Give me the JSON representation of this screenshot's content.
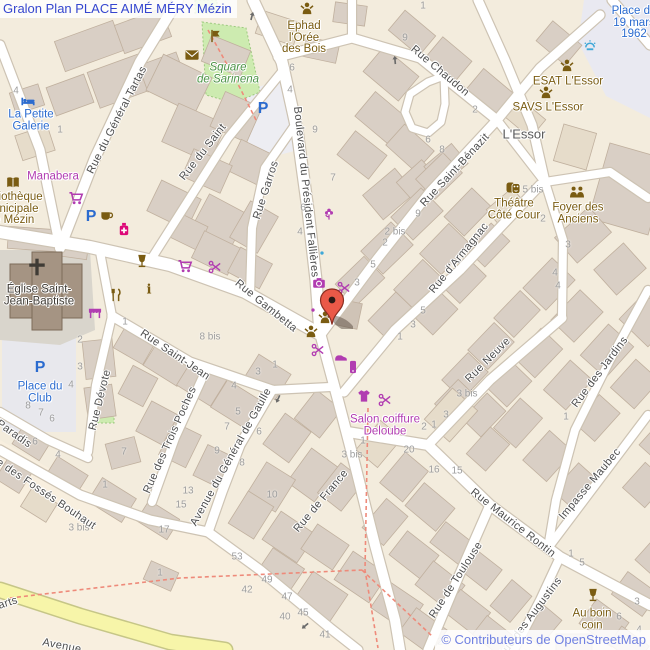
{
  "title": "Gralon Plan PLACE AIMÉ MÉRY Mézin",
  "attribution": "© Contributeurs de OpenStreetMap",
  "marker": {
    "x": 336,
    "y": 329,
    "color": "#ea5948"
  },
  "colors": {
    "purple": "#b13cb1",
    "brown": "#7a5c12",
    "pink": "#dd0878",
    "blue": "#2b6bcf",
    "green": "#4c9346",
    "gray_place": "#595959",
    "dark": "#3f3b35",
    "street": "#4d4d4d",
    "number": "#9e9e9e",
    "title": "#3546cf",
    "attribution": "#7081e2",
    "arrow": "#6b6b6b",
    "water": "#3fa8d8"
  },
  "streets": [
    {
      "t": "Rue du Général Tartas",
      "x": 117,
      "y": 120,
      "r": -63
    },
    {
      "t": "Rue du Saint",
      "x": 203,
      "y": 152,
      "r": -52
    },
    {
      "t": "Rue Garros",
      "x": 266,
      "y": 190,
      "r": -72
    },
    {
      "t": "Boulevard du Président Fallières",
      "x": 306,
      "y": 192,
      "r": 84
    },
    {
      "t": "Rue Chaudon",
      "x": 440,
      "y": 71,
      "r": 40
    },
    {
      "t": "Rue Saint-Bénazit",
      "x": 455,
      "y": 170,
      "r": -47
    },
    {
      "t": "Rue d'Armagnac",
      "x": 459,
      "y": 258,
      "r": -51
    },
    {
      "t": "Rue Gambetta",
      "x": 266,
      "y": 306,
      "r": 39
    },
    {
      "t": "Rue Saint-Jean",
      "x": 175,
      "y": 355,
      "r": 34
    },
    {
      "t": "Rue Dévote",
      "x": 100,
      "y": 400,
      "r": -76
    },
    {
      "t": "Rue des Trois Poches",
      "x": 170,
      "y": 440,
      "r": -66
    },
    {
      "t": "Avenue du Général de Gaulle",
      "x": 231,
      "y": 457,
      "r": -61
    },
    {
      "t": "Rue de France",
      "x": 321,
      "y": 501,
      "r": -50
    },
    {
      "t": "Rue Neuve",
      "x": 488,
      "y": 360,
      "r": -45
    },
    {
      "t": "Rue des Jardins",
      "x": 600,
      "y": 372,
      "r": -53
    },
    {
      "t": "Rue Maurice Rontin",
      "x": 513,
      "y": 523,
      "r": 38
    },
    {
      "t": "Impasse Maubec",
      "x": 590,
      "y": 484,
      "r": -50
    },
    {
      "t": "Rue de Toulouse",
      "x": 456,
      "y": 580,
      "r": -57
    },
    {
      "t": "Rue des Augustins",
      "x": 530,
      "y": 618,
      "r": -53
    },
    {
      "t": "Rue des Fossés Bouhaut",
      "x": 40,
      "y": 490,
      "r": 34
    },
    {
      "t": "Paradis",
      "x": 14,
      "y": 434,
      "r": 35
    },
    {
      "t": "arts",
      "x": 8,
      "y": 603,
      "r": -18
    },
    {
      "t": "Avenue",
      "x": 62,
      "y": 646,
      "r": 11
    }
  ],
  "pois": [
    {
      "n": "ephad-l-oree-des-bois",
      "lines": [
        "Ephad",
        "l'Orée",
        "des Bois"
      ],
      "x": 304,
      "y": 38,
      "c": "brown"
    },
    {
      "n": "square-de-sarinena",
      "lines": [
        "Square",
        "de Sarinena"
      ],
      "x": 228,
      "y": 74,
      "c": "green",
      "italic": true
    },
    {
      "n": "la-petite-galerie",
      "lines": [
        "La Petite",
        "Galerie"
      ],
      "x": 31,
      "y": 121,
      "c": "blue"
    },
    {
      "n": "manabera",
      "lines": [
        "Manabera"
      ],
      "x": 53,
      "y": 177,
      "c": "purple"
    },
    {
      "n": "bibliotheque-municipale",
      "lines": [
        "Bibliothèque",
        "municipale",
        "de Mézin"
      ],
      "x": 11,
      "y": 209,
      "c": "brown"
    },
    {
      "n": "eglise-saint-jean-baptiste",
      "lines": [
        "Église Saint-",
        "Jean-Baptiste"
      ],
      "x": 39,
      "y": 296,
      "c": "dark"
    },
    {
      "n": "place-du-club",
      "lines": [
        "Place du",
        "Club"
      ],
      "x": 40,
      "y": 393,
      "c": "blue"
    },
    {
      "n": "place-du-19-mars-1962",
      "lines": [
        "Place du",
        "19 mars",
        "1962"
      ],
      "x": 634,
      "y": 23,
      "c": "blue"
    },
    {
      "n": "esat-l-essor",
      "lines": [
        "ESAT L'Essor"
      ],
      "x": 568,
      "y": 82,
      "c": "brown"
    },
    {
      "n": "savs-l-essor",
      "lines": [
        "SAVS L'Essor"
      ],
      "x": 548,
      "y": 108,
      "c": "brown"
    },
    {
      "n": "l-essor",
      "lines": [
        "L'Essor"
      ],
      "x": 524,
      "y": 134,
      "c": "gray_place",
      "size": 13
    },
    {
      "n": "theatre-cote-cour",
      "lines": [
        "Théâtre",
        "Côté Cour"
      ],
      "x": 514,
      "y": 210,
      "c": "brown"
    },
    {
      "n": "foyer-des-anciens",
      "lines": [
        "Foyer des",
        "Anciens"
      ],
      "x": 578,
      "y": 214,
      "c": "brown"
    },
    {
      "n": "salon-coiffure-deloube",
      "lines": [
        "Salon coiffure",
        "Deloube"
      ],
      "x": 385,
      "y": 426,
      "c": "purple"
    },
    {
      "n": "au-boin-coin",
      "lines": [
        "Au boin",
        "coin"
      ],
      "x": 592,
      "y": 620,
      "c": "brown"
    }
  ],
  "icons": [
    {
      "k": "person",
      "x": 307,
      "y": 9,
      "c": "brown",
      "n": "ephad-icon"
    },
    {
      "k": "flag",
      "x": 215,
      "y": 36,
      "c": "brown",
      "n": "artwork-icon"
    },
    {
      "k": "mail",
      "x": 192,
      "y": 55,
      "c": "brown",
      "n": "post-box-icon"
    },
    {
      "k": "bed",
      "x": 28,
      "y": 101,
      "c": "blue",
      "n": "hotel-icon"
    },
    {
      "k": "book",
      "x": 13,
      "y": 183,
      "c": "brown",
      "n": "library-icon"
    },
    {
      "k": "shop",
      "x": 52,
      "y": 161,
      "c": "purple",
      "n": "shop-icon"
    },
    {
      "k": "cart",
      "x": 76,
      "y": 198,
      "c": "purple",
      "n": "supermarket-icon"
    },
    {
      "k": "P",
      "x": 263,
      "y": 107,
      "c": "blue",
      "n": "parking-icon"
    },
    {
      "k": "P",
      "x": 91,
      "y": 215,
      "c": "blue",
      "n": "parking-icon"
    },
    {
      "k": "P",
      "x": 40,
      "y": 366,
      "c": "blue",
      "n": "parking-icon"
    },
    {
      "k": "cup",
      "x": 107,
      "y": 216,
      "c": "brown",
      "n": "cafe-icon"
    },
    {
      "k": "pharmacy",
      "x": 124,
      "y": 229,
      "c": "pink",
      "n": "pharmacy-icon"
    },
    {
      "k": "wine",
      "x": 142,
      "y": 261,
      "c": "brown",
      "n": "bar-icon"
    },
    {
      "k": "cart",
      "x": 185,
      "y": 266,
      "c": "purple",
      "n": "supermarket-icon"
    },
    {
      "k": "hairdresser",
      "x": 215,
      "y": 267,
      "c": "purple",
      "n": "hairdresser-icon"
    },
    {
      "k": "awning",
      "x": 95,
      "y": 312,
      "c": "purple",
      "n": "marketplace-icon"
    },
    {
      "k": "cutlery",
      "x": 116,
      "y": 295,
      "c": "brown",
      "n": "restaurant-icon"
    },
    {
      "k": "info",
      "x": 149,
      "y": 289,
      "c": "brown",
      "n": "information-icon"
    },
    {
      "k": "cross",
      "x": 37,
      "y": 267,
      "c": "dark",
      "n": "church-cross-icon"
    },
    {
      "k": "flower",
      "x": 329,
      "y": 214,
      "c": "purple",
      "n": "florist-icon"
    },
    {
      "k": "shop",
      "x": 336,
      "y": 236,
      "c": "purple",
      "n": "shop-icon"
    },
    {
      "k": "dot",
      "x": 322,
      "y": 253,
      "c": "water",
      "n": "poi-dot-icon"
    },
    {
      "k": "camera",
      "x": 319,
      "y": 283,
      "c": "purple",
      "n": "photo-shop-icon"
    },
    {
      "k": "dot",
      "x": 313,
      "y": 310,
      "c": "purple",
      "n": "poi-dot-icon"
    },
    {
      "k": "hairdresser",
      "x": 344,
      "y": 288,
      "c": "purple",
      "n": "hairdresser-icon"
    },
    {
      "k": "person",
      "x": 325,
      "y": 318,
      "c": "brown",
      "n": "social-facility-icon"
    },
    {
      "k": "person",
      "x": 311,
      "y": 332,
      "c": "brown",
      "n": "social-facility-icon"
    },
    {
      "k": "hairdresser",
      "x": 318,
      "y": 350,
      "c": "purple",
      "n": "hairdresser-icon"
    },
    {
      "k": "shoe",
      "x": 341,
      "y": 357,
      "c": "purple",
      "n": "shoe-shop-icon"
    },
    {
      "k": "phone",
      "x": 353,
      "y": 367,
      "c": "purple",
      "n": "phone-shop-icon"
    },
    {
      "k": "shirt",
      "x": 364,
      "y": 396,
      "c": "purple",
      "n": "clothes-shop-icon"
    },
    {
      "k": "hairdresser",
      "x": 385,
      "y": 400,
      "c": "purple",
      "n": "hairdresser-icon"
    },
    {
      "k": "persons2",
      "x": 577,
      "y": 192,
      "c": "brown",
      "n": "community-centre-icon"
    },
    {
      "k": "masks",
      "x": 513,
      "y": 188,
      "c": "brown",
      "n": "theatre-icon"
    },
    {
      "k": "person",
      "x": 567,
      "y": 66,
      "c": "brown",
      "n": "esat-icon"
    },
    {
      "k": "person",
      "x": 546,
      "y": 93,
      "c": "brown",
      "n": "savs-icon"
    },
    {
      "k": "fountain",
      "x": 590,
      "y": 46,
      "c": "water",
      "n": "fountain-icon"
    },
    {
      "k": "wine",
      "x": 593,
      "y": 595,
      "c": "brown",
      "n": "bar-icon"
    },
    {
      "k": "arrow",
      "x": 278,
      "y": 399,
      "rot": 115,
      "c": "arrow",
      "n": "oneway-arrow-icon"
    },
    {
      "k": "arrow",
      "x": 305,
      "y": 626,
      "rot": 140,
      "c": "arrow",
      "n": "oneway-arrow-icon"
    },
    {
      "k": "arrow",
      "x": 395,
      "y": 60,
      "rot": -95,
      "c": "arrow",
      "n": "oneway-arrow-icon"
    },
    {
      "k": "arrow",
      "x": 252,
      "y": 16,
      "rot": -75,
      "c": "arrow",
      "n": "oneway-arrow-icon"
    }
  ],
  "house_numbers": [
    [
      "4",
      16,
      91
    ],
    [
      "1",
      60,
      130
    ],
    [
      "6",
      292,
      68
    ],
    [
      "4",
      290,
      90
    ],
    [
      "9",
      315,
      130
    ],
    [
      "7",
      333,
      178
    ],
    [
      "6",
      303,
      208
    ],
    [
      "4",
      300,
      232
    ],
    [
      "1",
      423,
      6
    ],
    [
      "9",
      405,
      38
    ],
    [
      "2",
      475,
      110
    ],
    [
      "6",
      428,
      140
    ],
    [
      "8",
      442,
      150
    ],
    [
      "9",
      418,
      214
    ],
    [
      "2 bis",
      395,
      232
    ],
    [
      "2",
      385,
      243
    ],
    [
      "5",
      373,
      265
    ],
    [
      "3",
      357,
      283
    ],
    [
      "5",
      423,
      311
    ],
    [
      "3",
      413,
      325
    ],
    [
      "1",
      400,
      337
    ],
    [
      "1",
      275,
      365
    ],
    [
      "3",
      258,
      372
    ],
    [
      "5 bis",
      533,
      190
    ],
    [
      "2",
      543,
      219
    ],
    [
      "3",
      568,
      245
    ],
    [
      "4",
      555,
      273
    ],
    [
      "4",
      558,
      286
    ],
    [
      "8 bis",
      210,
      337
    ],
    [
      "2",
      80,
      340
    ],
    [
      "3",
      80,
      367
    ],
    [
      "4",
      71,
      385
    ],
    [
      "8",
      28,
      406
    ],
    [
      "7",
      41,
      413
    ],
    [
      "6",
      52,
      419
    ],
    [
      "1",
      125,
      322
    ],
    [
      "6",
      35,
      442
    ],
    [
      "4",
      58,
      455
    ],
    [
      "7",
      124,
      452
    ],
    [
      "1",
      105,
      485
    ],
    [
      "13",
      188,
      491
    ],
    [
      "15",
      181,
      505
    ],
    [
      "17",
      164,
      530
    ],
    [
      "3 bis",
      79,
      528
    ],
    [
      "9",
      217,
      451
    ],
    [
      "4",
      234,
      386
    ],
    [
      "5",
      238,
      412
    ],
    [
      "7",
      227,
      427
    ],
    [
      "6",
      259,
      432
    ],
    [
      "8",
      242,
      463
    ],
    [
      "10",
      272,
      495
    ],
    [
      "53",
      237,
      557
    ],
    [
      "49",
      267,
      580
    ],
    [
      "42",
      247,
      590
    ],
    [
      "47",
      287,
      597
    ],
    [
      "40",
      285,
      617
    ],
    [
      "45",
      303,
      613
    ],
    [
      "41",
      325,
      635
    ],
    [
      "1",
      160,
      573
    ],
    [
      "1",
      363,
      441
    ],
    [
      "3 bis",
      352,
      455
    ],
    [
      "20",
      409,
      450
    ],
    [
      "2",
      424,
      427
    ],
    [
      "1",
      434,
      425
    ],
    [
      "3",
      446,
      415
    ],
    [
      "16",
      434,
      470
    ],
    [
      "15",
      457,
      471
    ],
    [
      "3 bis",
      467,
      394
    ],
    [
      "1",
      566,
      417
    ],
    [
      "1",
      571,
      554
    ],
    [
      "5",
      582,
      563
    ],
    [
      "3",
      637,
      602
    ],
    [
      "6",
      619,
      617
    ],
    [
      "4",
      639,
      630
    ],
    [
      "2",
      440,
      642
    ]
  ]
}
